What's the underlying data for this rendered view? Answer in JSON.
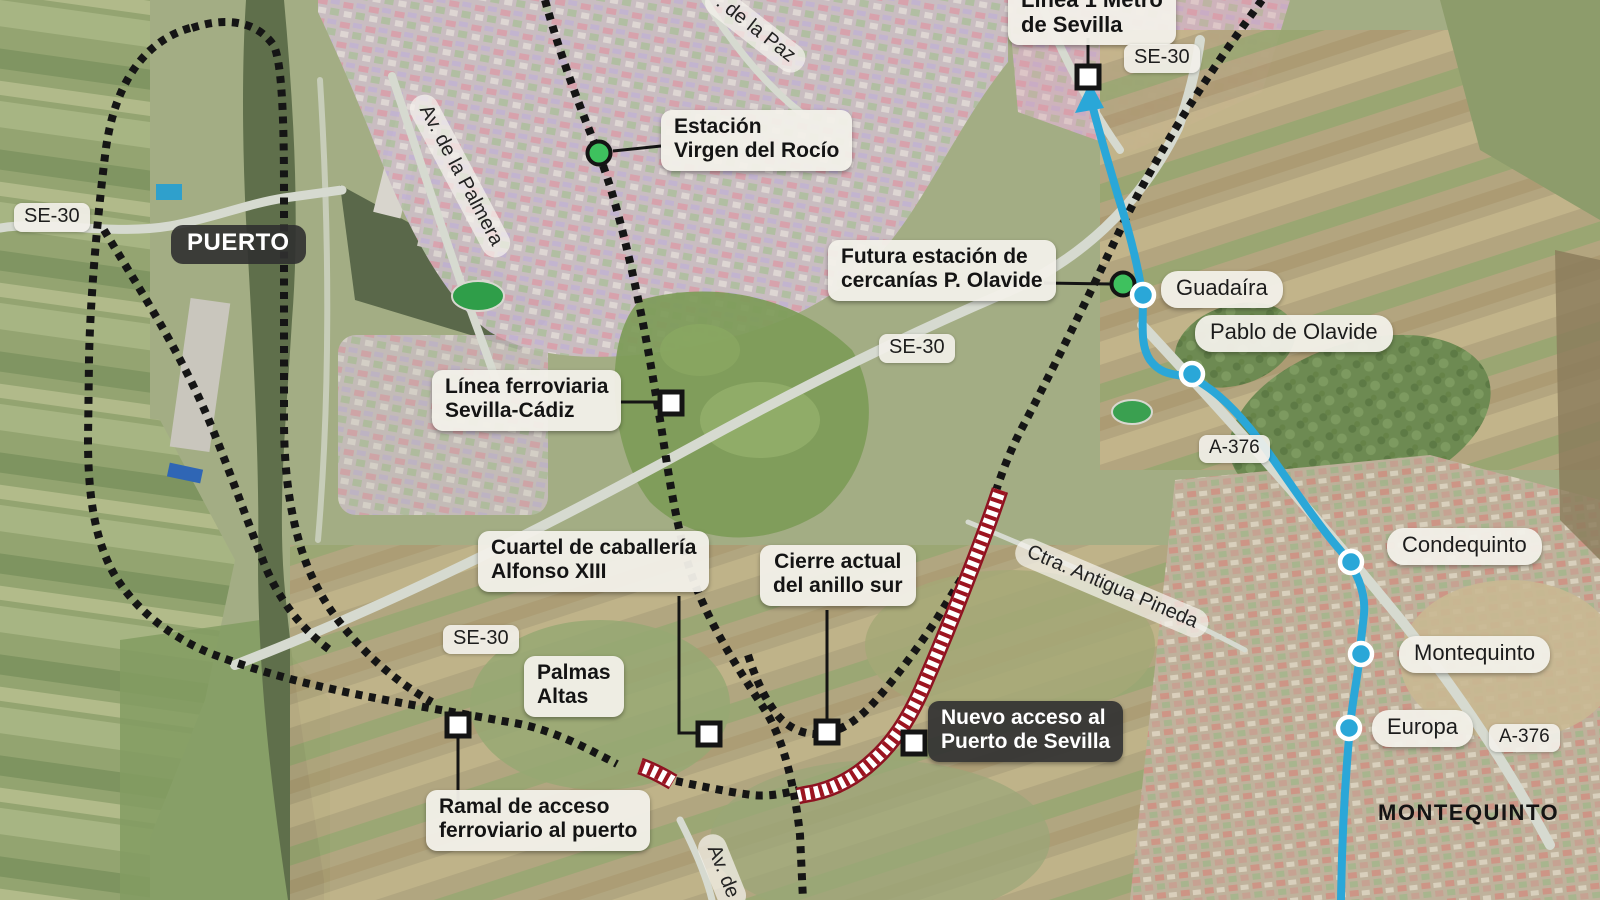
{
  "colors": {
    "metro_line_blue": "#2aa7d8",
    "railway_dotted_black": "#151515",
    "new_access_red": "#9c1420",
    "cercanias_station_green": "#3ec15e",
    "light_label_bg": "#f2f0e9",
    "dark_label_bg": "#333333"
  },
  "areas": {
    "puerto": "PUERTO",
    "montequinto": "MONTEQUINTO"
  },
  "roads": {
    "se30_left": "SE-30",
    "se30_top": "SE-30",
    "se30_mid": "SE-30",
    "se30_sw": "SE-30",
    "a376_mid": "A-376",
    "a376_se": "A-376",
    "av_palmera": "Av. de la Palmera",
    "av_paz": ". de la Paz",
    "ctra_pineda": "Ctra. Antigua Pineda",
    "av_bottom": "Av. de"
  },
  "annotations": {
    "linea1_metro": {
      "line1": "Línea 1 Metro",
      "line2": "de Sevilla"
    },
    "estacion_virgen": {
      "line1": "Estación",
      "line2": "Virgen del Rocío"
    },
    "futura_olavide": {
      "line1": "Futura estación de",
      "line2": "cercanías P. Olavide"
    },
    "linea_ferroviaria": {
      "line1": "Línea ferroviaria",
      "line2": "Sevilla-Cádiz"
    },
    "cuartel": {
      "line1": "Cuartel de caballería",
      "line2": "Alfonso XIII"
    },
    "cierre": {
      "line1": "Cierre actual",
      "line2": "del anillo sur"
    },
    "palmas_altas": {
      "line1": "Palmas",
      "line2": "Altas"
    },
    "ramal": {
      "line1": "Ramal de acceso",
      "line2": "ferroviario al puerto"
    },
    "nuevo_acceso": {
      "line1": "Nuevo acceso al",
      "line2": "Puerto de Sevilla"
    }
  },
  "metro_stations": {
    "guadaira": "Guadaíra",
    "pablo_olavide": "Pablo de Olavide",
    "condequinto": "Condequinto",
    "montequinto": "Montequinto",
    "europa": "Europa"
  }
}
